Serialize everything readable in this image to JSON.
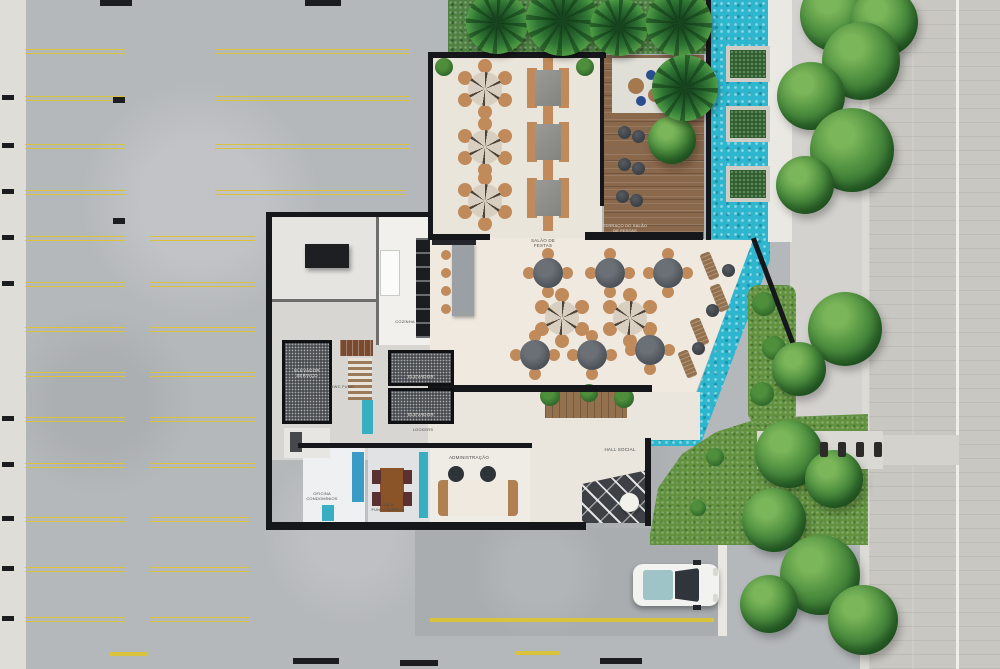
{
  "title": "Condominium ground-floor plan render with parking, party hall, pool and street",
  "labels": {
    "party_hall": "SALÃO DE FESTAS",
    "party_hall_terrace": "TERRAÇO DO SALÃO DE FESTAS",
    "kitchen": "COZINHA",
    "service_elevator": "ELEVADOR SERVIÇO",
    "elevator_1": "ELEVADOR",
    "elevator_2": "ELEVADOR",
    "lockers": "LOCKERS",
    "staff_wc": "BWC FUNC.",
    "condo_office": "OFICINA CONDOMÍNIOS",
    "staff_room": "SALA FUNCIONÁRIOS",
    "administration": "ADMINISTRAÇÃO",
    "social_hall": "HALL SOCIAL"
  },
  "colors": {
    "parking_asphalt": "#b5b8bb",
    "parking_stripe_yellow": "#d9c33c",
    "stripe_black": "#1c1d20",
    "wall_black": "#16171a",
    "floor_cream": "#eceade",
    "pool_turquoise": "#2db6cd",
    "deck_wood": "#8a684c",
    "grass_green": "#62923f",
    "tree_green": "#4f9140",
    "street_pavers": "#c9c7c1",
    "chair_wood": "#c08a5a",
    "table_charcoal": "#4a4f55",
    "accent_teal": "#38aec2",
    "accent_blue_cabinet": "#3a9bc7",
    "car_body": "#f2f3f1"
  }
}
